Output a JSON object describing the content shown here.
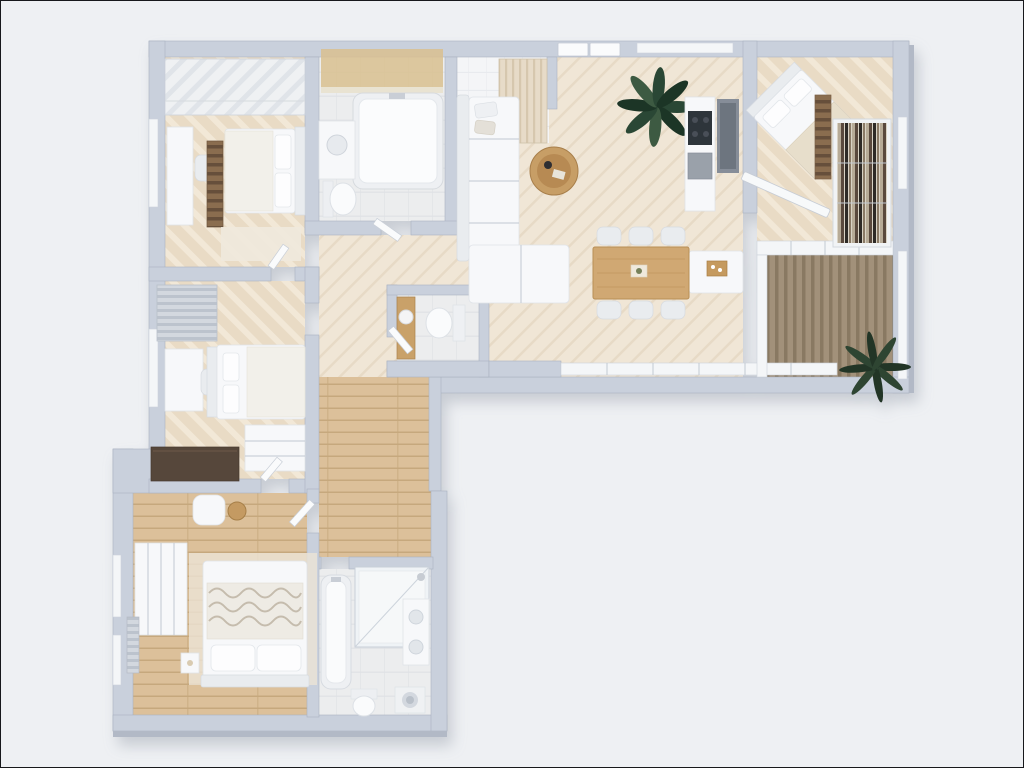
{
  "meta": {
    "image_type": "floor-plan-3d-render",
    "view": "top-down dollhouse view of an L-shaped apartment",
    "visible_text": "none"
  },
  "colors": {
    "bg": "#eef0f3",
    "wall": "#c9d0dc",
    "wallFace": "#b2b9c6",
    "glass": "#f4f6f8",
    "floorBeige": "#e9dbc5",
    "floorBeigeLight": "#f2e8d7",
    "floorCream": "#f0e6d6",
    "floorCreamLine": "#e7dac6",
    "floorWood": "#dcc09a",
    "floorWoodLine": "#c6a87d",
    "tile": "#ecedee",
    "tileLine": "#dfe1e5",
    "entryTile": "#f4f5f7",
    "deck": "#a2917a",
    "deckLine": "#897962",
    "white": "#f7f8fa",
    "wood": "#cda26c",
    "woodDark": "#a87f4b",
    "darkCabinet": "#57463a",
    "appliance": "#2f343b",
    "plant": "#2b4634",
    "plantDark": "#1d3426",
    "glow": "#d9c08f"
  },
  "rooms": [
    {
      "name": "bedroom-top-left",
      "furniture": [
        "wardrobe",
        "desk",
        "desk-chair",
        "ladder-shelf",
        "bed",
        "rug"
      ]
    },
    {
      "name": "main-bathroom",
      "furniture": [
        "lit-vanity",
        "bathtub",
        "washbasin",
        "toilet"
      ]
    },
    {
      "name": "entry-hall",
      "furniture": [
        "front-double-door",
        "fluted-wardrobe"
      ]
    },
    {
      "name": "living-room",
      "furniture": [
        "sectional-sofa",
        "throw-pillows",
        "round-coffee-table",
        "potted-plant"
      ]
    },
    {
      "name": "kitchen",
      "furniture": [
        "counter",
        "cooktop",
        "appliance",
        "tall-cabinet",
        "island",
        "serving-tray"
      ]
    },
    {
      "name": "dining-area",
      "furniture": [
        "dining-table",
        "six-chairs",
        "centerpiece"
      ]
    },
    {
      "name": "bedroom-top-right",
      "furniture": [
        "diagonal-bed",
        "ladder-rack",
        "bookshelf",
        "open-glass-door"
      ]
    },
    {
      "name": "balcony",
      "furniture": [
        "wood-slat-deck",
        "outdoor-plant"
      ]
    },
    {
      "name": "guest-wc",
      "furniture": [
        "wood-vanity",
        "round-washbasin",
        "toilet"
      ]
    },
    {
      "name": "bedroom-middle-left",
      "furniture": [
        "striped-cabinet",
        "desk",
        "chair",
        "bed",
        "dresser",
        "dark-sideboard"
      ]
    },
    {
      "name": "corridor",
      "furniture": []
    },
    {
      "name": "master-bedroom",
      "furniture": [
        "wardrobe",
        "armchair",
        "side-table",
        "bed",
        "wavy-blanket",
        "nightstand",
        "radiator",
        "rug"
      ]
    },
    {
      "name": "master-bathroom",
      "furniture": [
        "bathtub",
        "shower",
        "vanity",
        "toilet",
        "washing-machine"
      ]
    }
  ]
}
